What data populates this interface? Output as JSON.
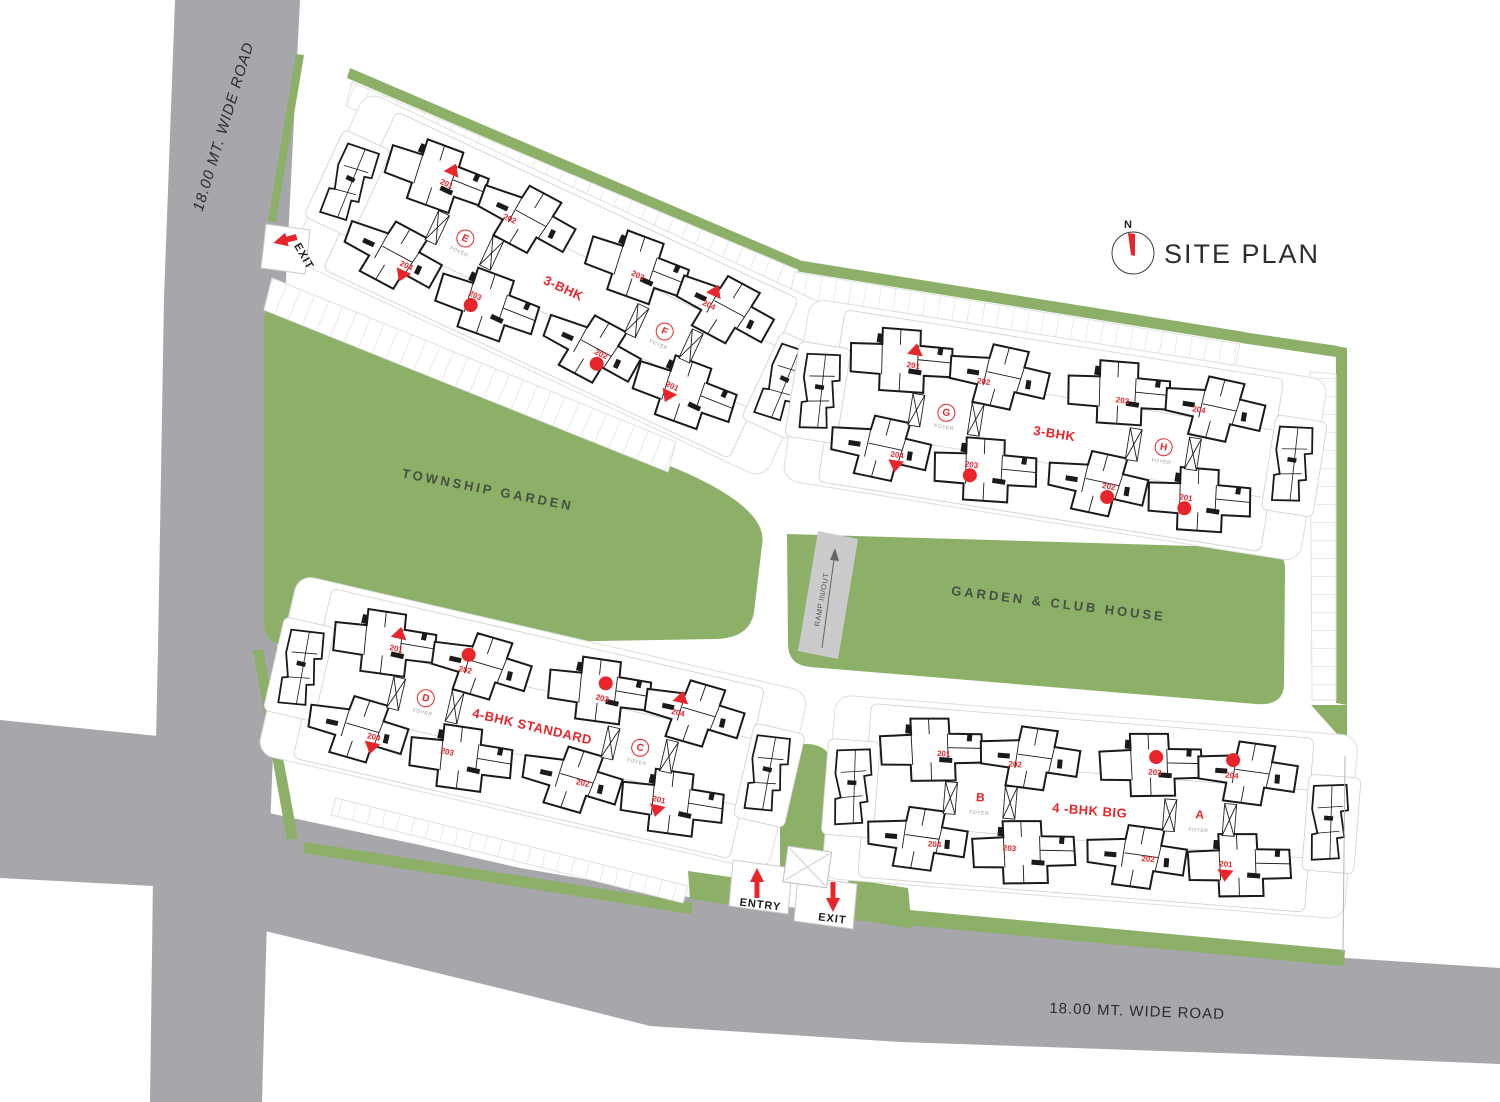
{
  "title": "SITE PLAN",
  "compass": {
    "north_label": "N"
  },
  "roads": {
    "left_label": "18.00 MT. WIDE ROAD",
    "bottom_label": "18.00 MT. WIDE ROAD"
  },
  "areas": {
    "township_garden": "TOWNSHIP GARDEN",
    "garden_club_house": "GARDEN & CLUB HOUSE",
    "ramp_label": "RAMP IN/OUT"
  },
  "gates": {
    "entry_label": "ENTRY",
    "exit_label": "EXIT",
    "top_exit_label": "EXIT"
  },
  "colors": {
    "garden_green": "#8cb068",
    "road_gray": "#a7a6aa",
    "ramp_gray": "#cbcbcd",
    "accent_red": "#e8252b",
    "ink": "#2c2c2e"
  },
  "clusters": [
    {
      "id": "EF",
      "type_label": "3-BHK",
      "cx": 565,
      "cy": 285,
      "angle": 25,
      "towers": [
        {
          "name": "E",
          "foyer": "FOYER",
          "circled": true
        },
        {
          "name": "F",
          "foyer": "FOYER",
          "circled": true
        }
      ],
      "units": [
        {
          "no": "201",
          "slot": "TL1",
          "marker": "tri-up",
          "marker_pos": "above"
        },
        {
          "no": "202",
          "slot": "TL2",
          "marker": "none"
        },
        {
          "no": "203",
          "slot": "TR1",
          "marker": "none"
        },
        {
          "no": "204",
          "slot": "TR2",
          "marker": "tri-up",
          "marker_pos": "above"
        },
        {
          "no": "204",
          "slot": "BL1",
          "marker": "tri-down",
          "marker_pos": "below"
        },
        {
          "no": "203",
          "slot": "BL2",
          "marker": "dot",
          "marker_pos": "below"
        },
        {
          "no": "202",
          "slot": "BR1",
          "marker": "dot",
          "marker_pos": "below"
        },
        {
          "no": "201",
          "slot": "BR2",
          "marker": "tri-down",
          "marker_pos": "below"
        }
      ]
    },
    {
      "id": "GH",
      "type_label": "3-BHK",
      "cx": 1055,
      "cy": 430,
      "angle": 9,
      "towers": [
        {
          "name": "G",
          "foyer": "FOYER",
          "circled": true
        },
        {
          "name": "H",
          "foyer": "FOYER",
          "circled": true
        }
      ],
      "units": [
        {
          "no": "201",
          "slot": "TL1",
          "marker": "tri-up",
          "marker_pos": "above"
        },
        {
          "no": "202",
          "slot": "TL2",
          "marker": "none"
        },
        {
          "no": "203",
          "slot": "TR1",
          "marker": "none"
        },
        {
          "no": "204",
          "slot": "TR2",
          "marker": "none"
        },
        {
          "no": "204",
          "slot": "BL1",
          "marker": "tri-down",
          "marker_pos": "below"
        },
        {
          "no": "203",
          "slot": "BL2",
          "marker": "dot",
          "marker_pos": "below"
        },
        {
          "no": "202",
          "slot": "BR1",
          "marker": "dot",
          "marker_pos": "below"
        },
        {
          "no": "201",
          "slot": "BR2",
          "marker": "dot",
          "marker_pos": "below"
        }
      ]
    },
    {
      "id": "DC",
      "type_label": "4-BHK STANDARD",
      "cx": 533,
      "cy": 723,
      "angle": 13,
      "towers": [
        {
          "name": "D",
          "foyer": "FOYER",
          "circled": true
        },
        {
          "name": "C",
          "foyer": "FOYER",
          "circled": true
        }
      ],
      "units": [
        {
          "no": "201",
          "slot": "TL1",
          "marker": "tri-up",
          "marker_pos": "above"
        },
        {
          "no": "202",
          "slot": "TL2",
          "marker": "dot",
          "marker_pos": "above"
        },
        {
          "no": "203",
          "slot": "TR1",
          "marker": "dot",
          "marker_pos": "above"
        },
        {
          "no": "204",
          "slot": "TR2",
          "marker": "tri-up",
          "marker_pos": "above"
        },
        {
          "no": "204",
          "slot": "BL1",
          "marker": "tri-down",
          "marker_pos": "below"
        },
        {
          "no": "203",
          "slot": "BL2",
          "marker": "none"
        },
        {
          "no": "202",
          "slot": "BR1",
          "marker": "none"
        },
        {
          "no": "201",
          "slot": "BR2",
          "marker": "tri-down",
          "marker_pos": "below"
        }
      ]
    },
    {
      "id": "BA",
      "type_label": "4 -BHK BIG",
      "cx": 1090,
      "cy": 807,
      "angle": 4.5,
      "towers": [
        {
          "name": "B",
          "foyer": "FOYER",
          "circled": false
        },
        {
          "name": "A",
          "foyer": "FOYER",
          "circled": false
        }
      ],
      "units": [
        {
          "no": "201",
          "slot": "TL1",
          "marker": "none"
        },
        {
          "no": "202",
          "slot": "TL2",
          "marker": "none"
        },
        {
          "no": "203",
          "slot": "TR1",
          "marker": "dot",
          "marker_pos": "above"
        },
        {
          "no": "204",
          "slot": "TR2",
          "marker": "dot",
          "marker_pos": "above"
        },
        {
          "no": "204",
          "slot": "BL1",
          "marker": "none"
        },
        {
          "no": "203",
          "slot": "BL2",
          "marker": "none"
        },
        {
          "no": "202",
          "slot": "BR1",
          "marker": "none"
        },
        {
          "no": "201",
          "slot": "BR2",
          "marker": "tri-down",
          "marker_pos": "below"
        }
      ]
    }
  ]
}
